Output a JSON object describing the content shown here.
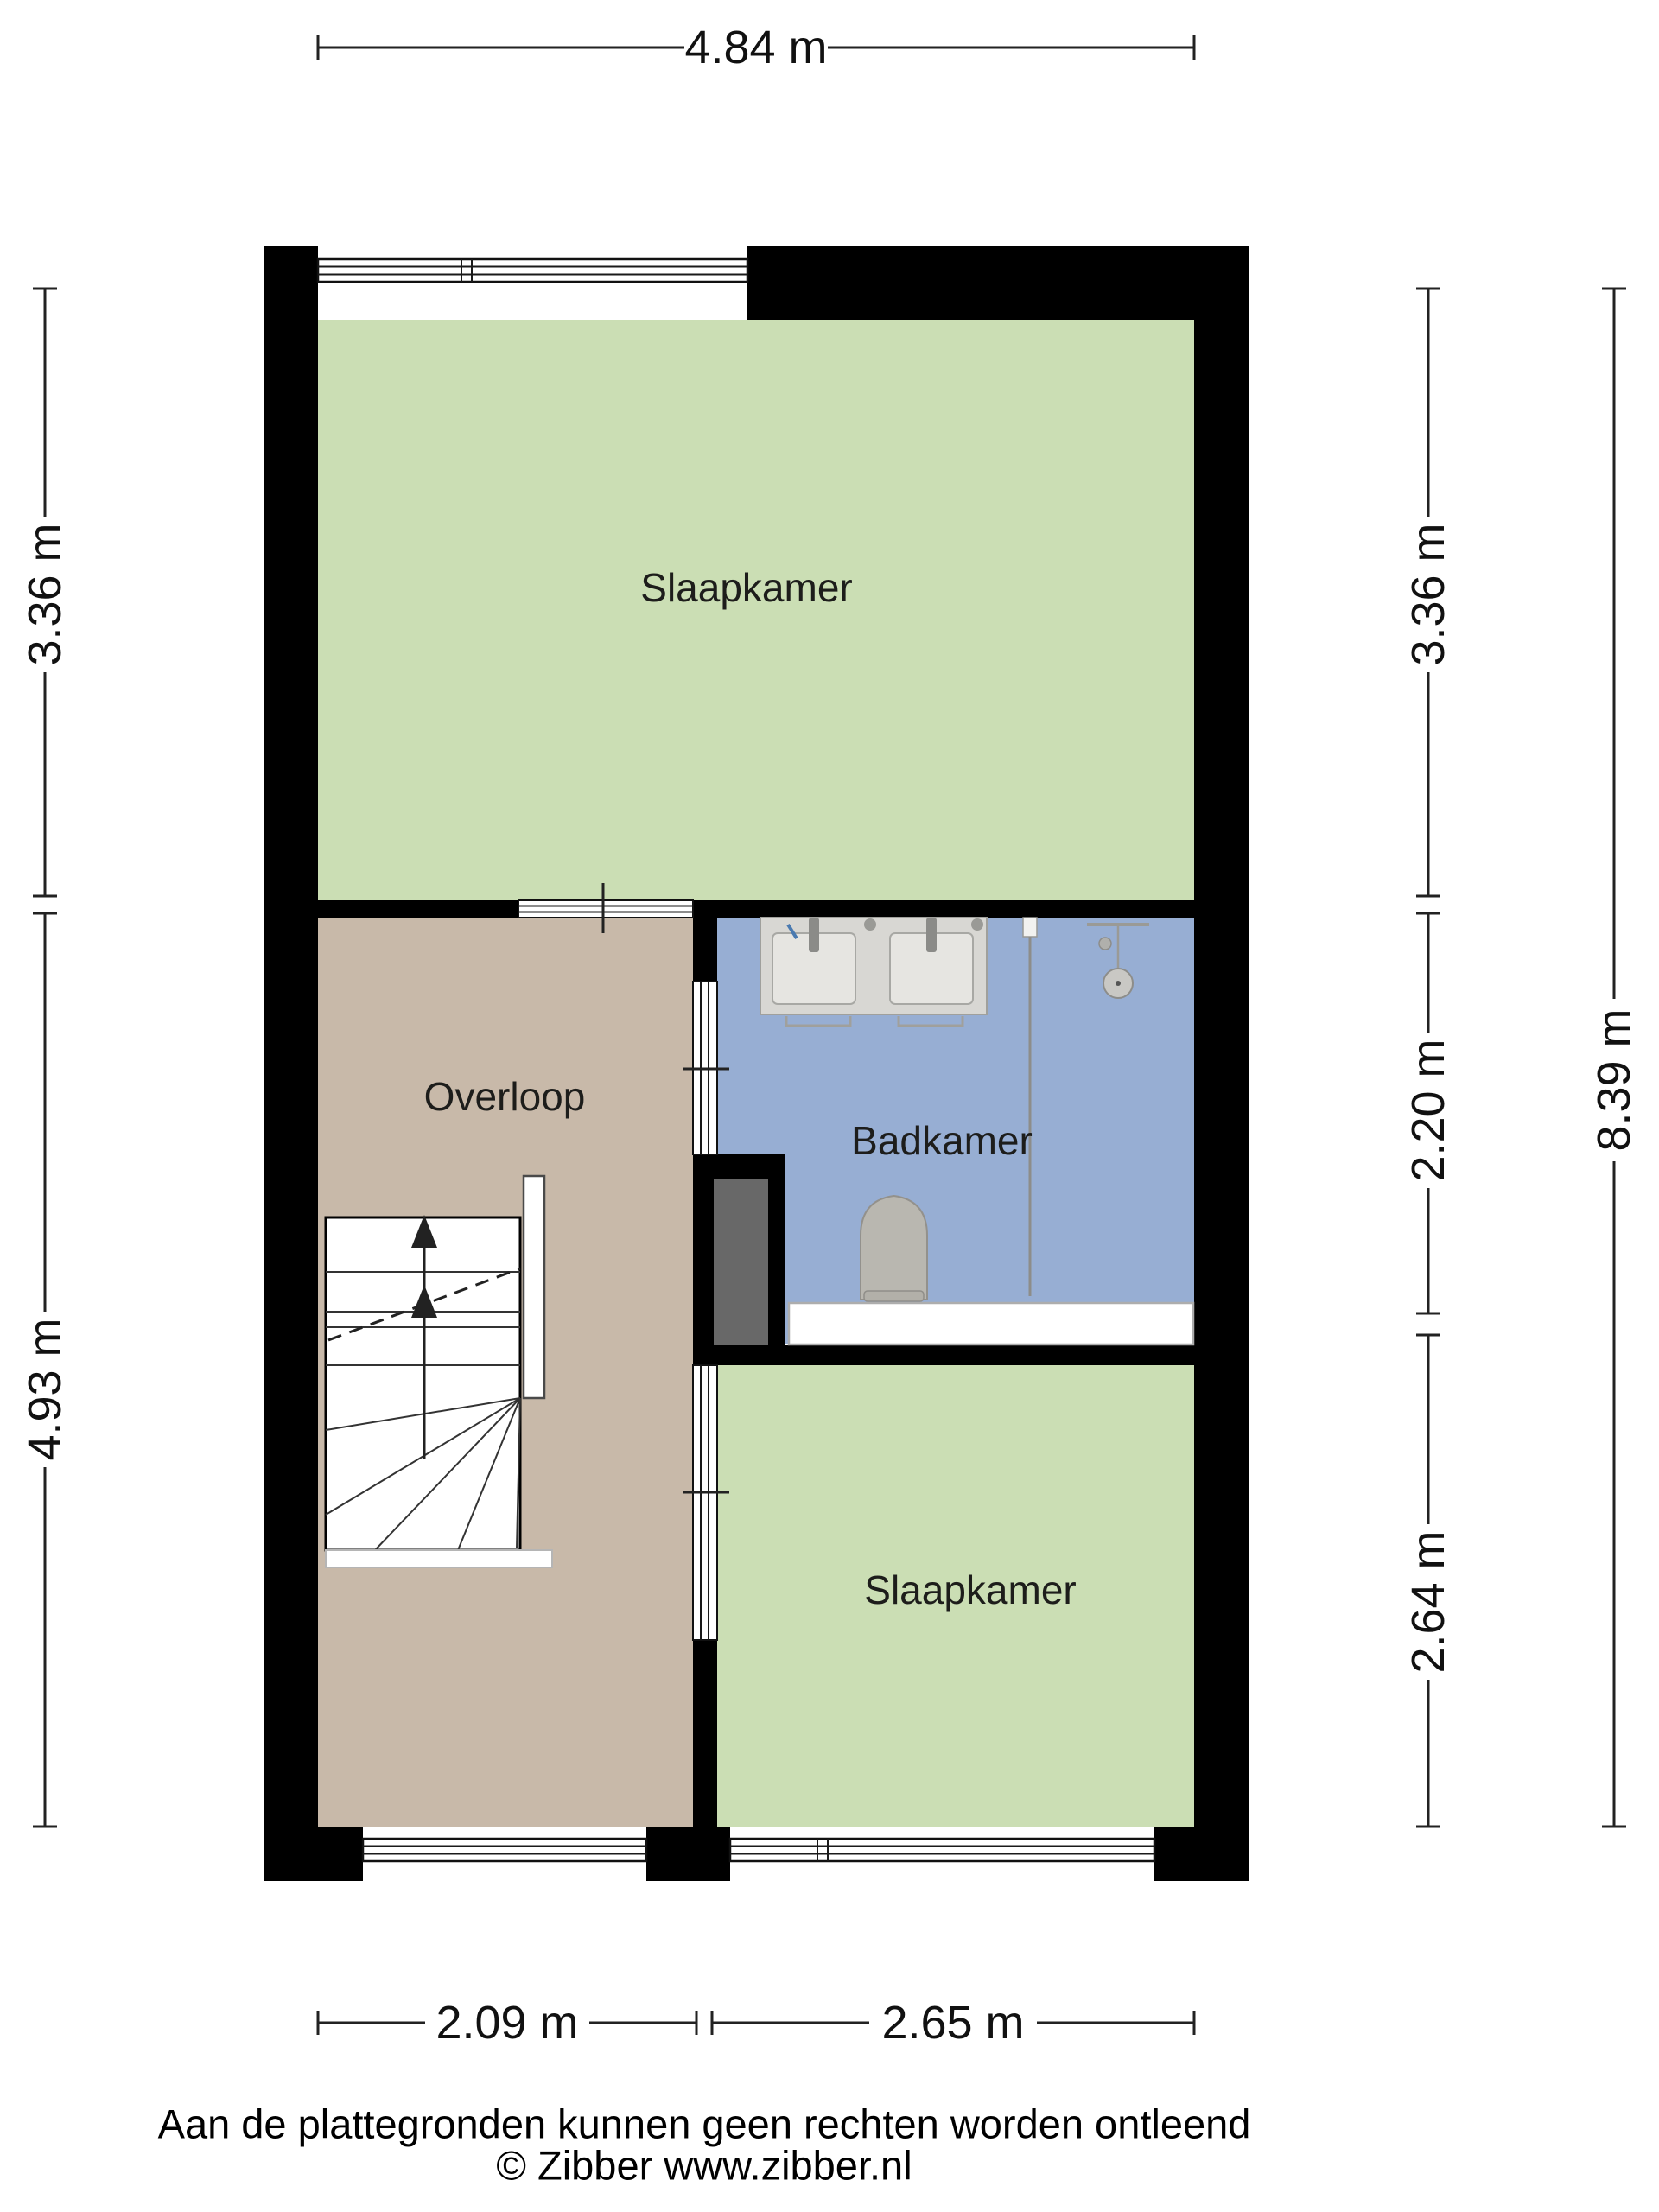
{
  "plan_type": "floor-plan",
  "rooms": {
    "bedroom_top": {
      "label": "Slaapkamer"
    },
    "landing": {
      "label": "Overloop"
    },
    "bathroom": {
      "label": "Badkamer"
    },
    "bedroom_bottom": {
      "label": "Slaapkamer"
    }
  },
  "dimensions": {
    "top_width": "4.84 m",
    "left_upper": "3.36 m",
    "left_lower": "4.93 m",
    "right_upper": "3.36 m",
    "right_middle": "2.20 m",
    "right_lower": "2.64 m",
    "right_total": "8.39 m",
    "bottom_left": "2.09 m",
    "bottom_right": "2.65 m"
  },
  "footer": {
    "disclaimer": "Aan de plattegronden kunnen geen rechten worden ontleend",
    "copyright": "© Zibber www.zibber.nl"
  },
  "colors": {
    "wall": "#000000",
    "bedroom": "#cbdeb4",
    "landing": "#c8b9a9",
    "bathroom": "#97aed3",
    "shaft": "#686868",
    "fixture": "#d8d7d3",
    "tub": "#ffffff"
  }
}
